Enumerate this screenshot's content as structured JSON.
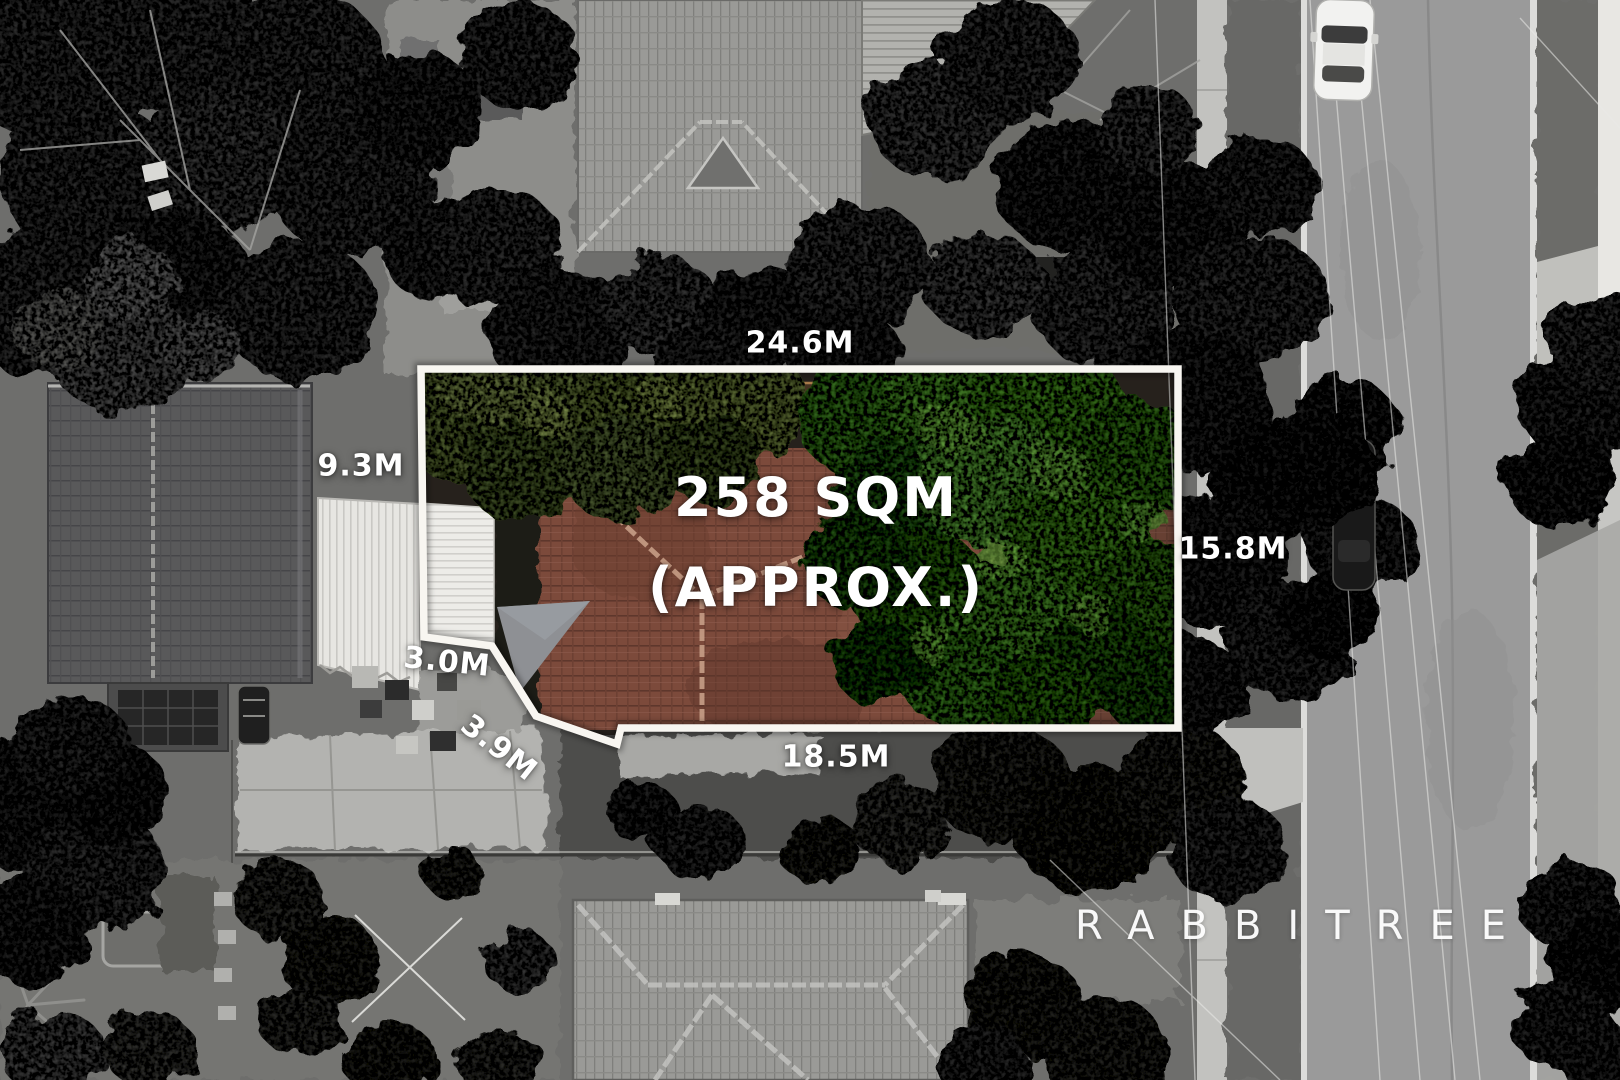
{
  "image_type": "aerial-drone-property-photo",
  "property_overlay": {
    "area_label": {
      "line1": "258 SQM",
      "line2": "(APPROX.)"
    },
    "dimensions": {
      "top": "24.6M",
      "left": "9.3M",
      "right": "15.8M",
      "bottom": "18.5M",
      "notch_width": "3.0M",
      "notch_diagonal": "3.9M"
    }
  },
  "watermark": {
    "text": "RABBITREE"
  },
  "palette": {
    "boundary_line": "#f8f6f1",
    "label_text": "#ffffff",
    "roof_red": "#7c4a3b",
    "roof_ridge_red": "#c79e87",
    "tree_green_bright": "#4c8a2f",
    "tree_green_olive": "#5f7038",
    "grayscale_tree": "#383838",
    "road_asphalt": "#9a9a9a",
    "concrete": "#c2c2bf",
    "white_metal_roof": "#e9e8e4"
  }
}
